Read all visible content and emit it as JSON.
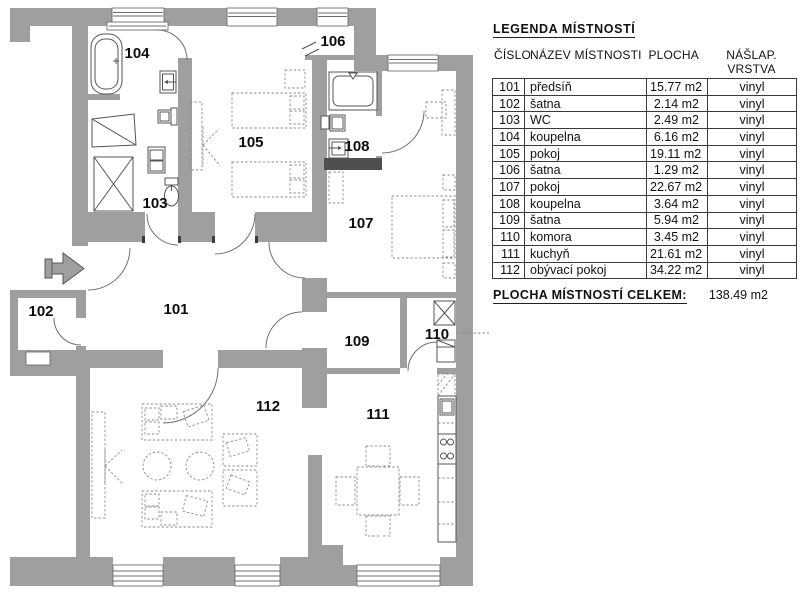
{
  "legend": {
    "title": "LEGENDA MÍSTNOSTÍ",
    "columns": [
      "ČÍSLO",
      "NÁZEV MÍSTNOSTI",
      "PLOCHA",
      "NÁŠLAP. VRSTVA"
    ],
    "rows": [
      {
        "number": "101",
        "name": "předsíň",
        "area": "15.77 m2",
        "layer": "vinyl"
      },
      {
        "number": "102",
        "name": "šatna",
        "area": "2.14 m2",
        "layer": "vinyl"
      },
      {
        "number": "103",
        "name": "WC",
        "area": "2.49 m2",
        "layer": "vinyl"
      },
      {
        "number": "104",
        "name": "koupelna",
        "area": "6.16 m2",
        "layer": "vinyl"
      },
      {
        "number": "105",
        "name": "pokoj",
        "area": "19.11 m2",
        "layer": "vinyl"
      },
      {
        "number": "106",
        "name": "šatna",
        "area": "1.29 m2",
        "layer": "vinyl"
      },
      {
        "number": "107",
        "name": "pokoj",
        "area": "22.67 m2",
        "layer": "vinyl"
      },
      {
        "number": "108",
        "name": "koupelna",
        "area": "3.64 m2",
        "layer": "vinyl"
      },
      {
        "number": "109",
        "name": "šatna",
        "area": "5.94 m2",
        "layer": "vinyl"
      },
      {
        "number": "110",
        "name": "komora",
        "area": "3.45 m2",
        "layer": "vinyl"
      },
      {
        "number": "111",
        "name": "kuchyň",
        "area": "21.61 m2",
        "layer": "vinyl"
      },
      {
        "number": "112",
        "name": "obývací pokoj",
        "area": "34.22 m2",
        "layer": "vinyl"
      }
    ],
    "total_label": "PLOCHA MÍSTNOSTÍ CELKEM:",
    "total_value": "138.49 m2"
  },
  "floorplan": {
    "fixture_icons": [
      "bathtub-icon",
      "sink-icon",
      "toilet-icon",
      "shower-icon",
      "washing-machine-icon",
      "shaft-x-icon",
      "dresser-icon",
      "double-bed-icon",
      "wardrobe-icon",
      "sofa-set-icon",
      "coffee-table-icon",
      "armchair-icon",
      "dining-table-icon",
      "kitchen-counter-icon",
      "kitchen-sink-icon",
      "stove-icon",
      "water-heater-icon",
      "vent-shaft-icon",
      "entrance-arrow-icon",
      "wall-break-icon",
      "window-icon",
      "door-swing-icon"
    ],
    "colors": {
      "wall": "#9f9f9f",
      "fixture_line": "#555555",
      "furniture_dash": "#8a8a8a",
      "table_line": "#3a3a3a",
      "text": "#111111"
    }
  }
}
